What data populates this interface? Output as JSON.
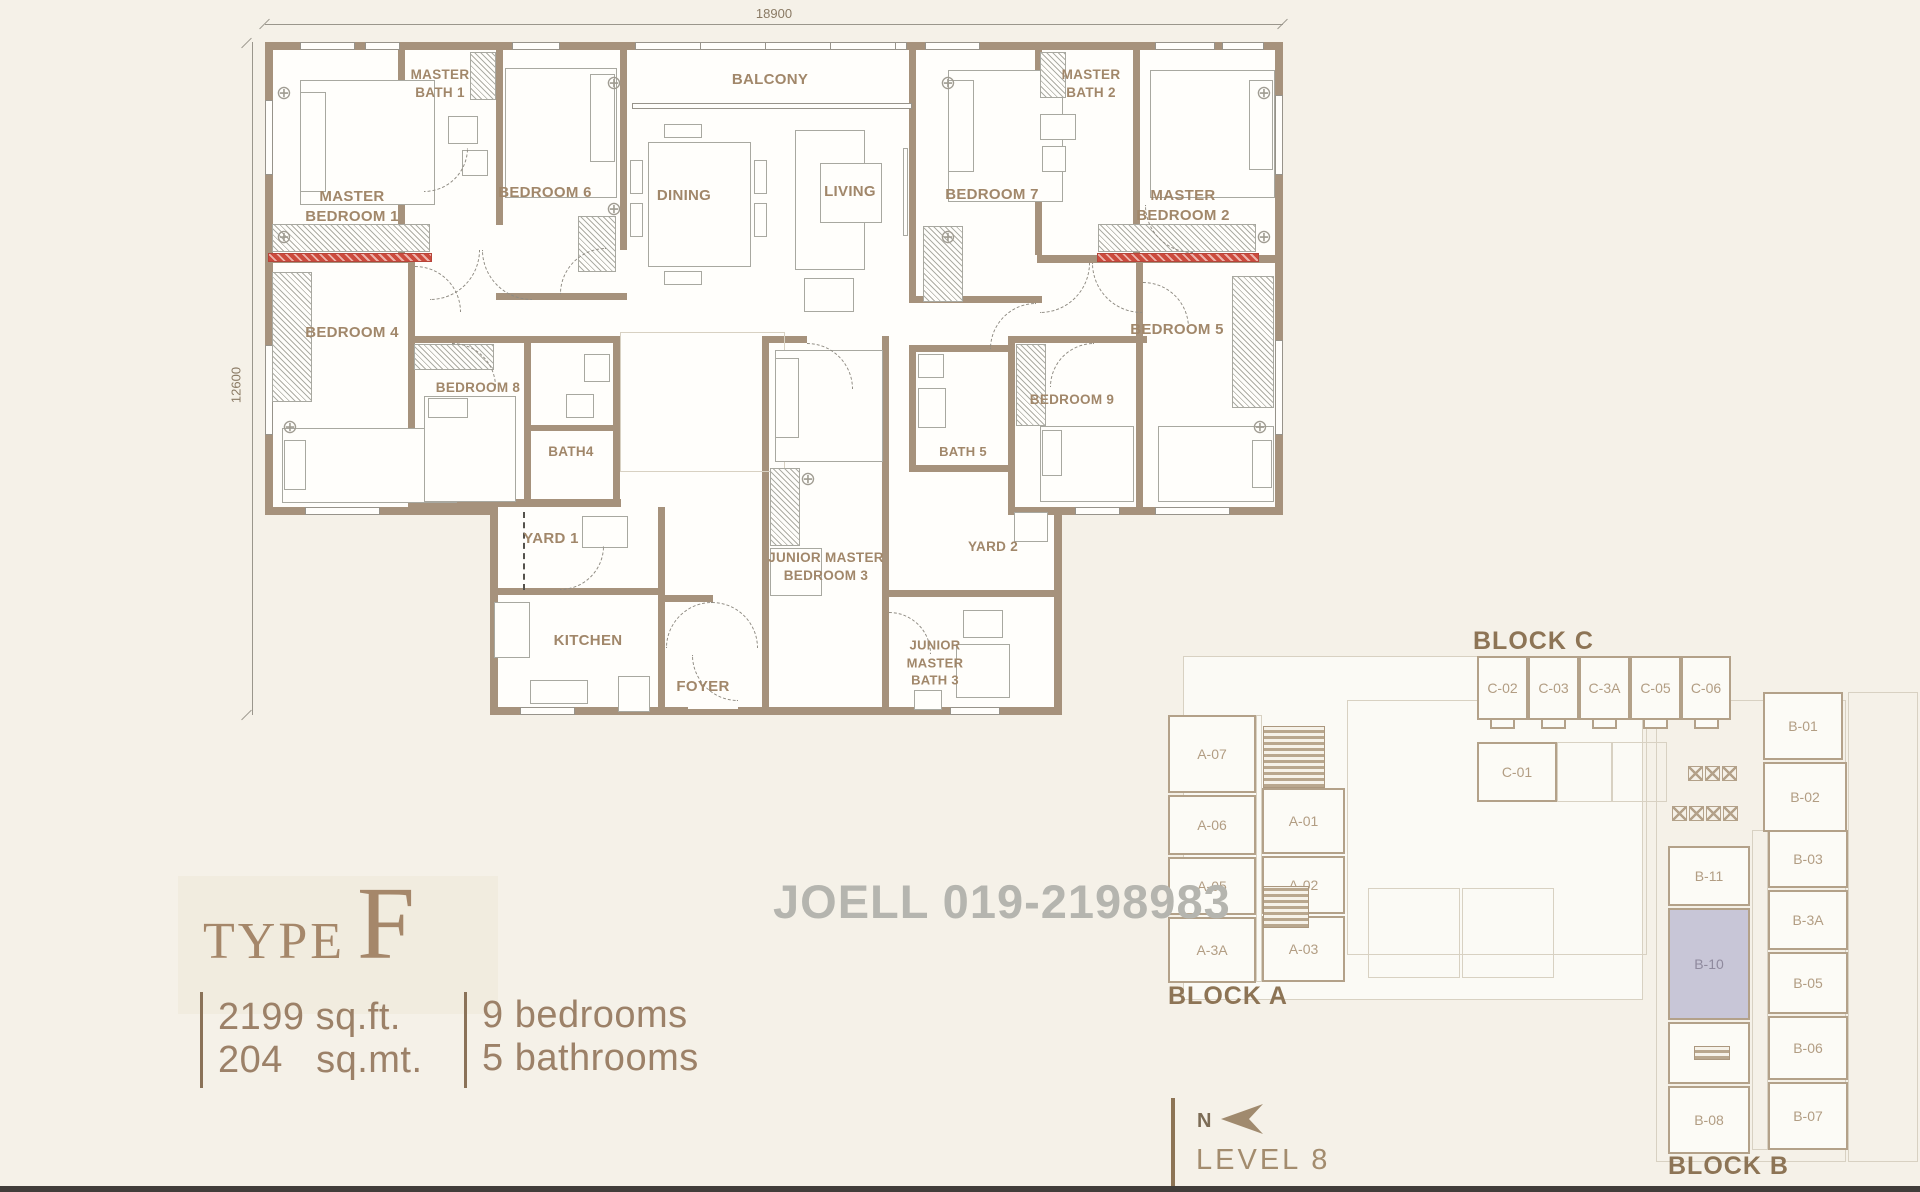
{
  "dimensions": {
    "top": "18900",
    "left": "12600"
  },
  "watermark": "JOELL 019-2198983",
  "title_block": {
    "type_word": "TYPE",
    "type_letter": "F",
    "area_imperial": "2199 sq.ft.",
    "area_metric": "204   sq.mt.",
    "bedrooms": "9 bedrooms",
    "bathrooms": "5 bathrooms"
  },
  "rooms": [
    {
      "id": "master-bedroom-1",
      "label": "MASTER\nBEDROOM 1"
    },
    {
      "id": "master-bath-1",
      "label": "MASTER\nBATH 1"
    },
    {
      "id": "bedroom-6",
      "label": "BEDROOM 6"
    },
    {
      "id": "balcony",
      "label": "BALCONY"
    },
    {
      "id": "dining",
      "label": "DINING"
    },
    {
      "id": "living",
      "label": "LIVING"
    },
    {
      "id": "bedroom-7",
      "label": "BEDROOM 7"
    },
    {
      "id": "master-bath-2",
      "label": "MASTER\nBATH 2"
    },
    {
      "id": "master-bedroom-2",
      "label": "MASTER\nBEDROOM 2"
    },
    {
      "id": "bedroom-4",
      "label": "BEDROOM 4"
    },
    {
      "id": "bedroom-8",
      "label": "BEDROOM 8"
    },
    {
      "id": "bath-4",
      "label": "BATH4"
    },
    {
      "id": "bedroom-9",
      "label": "BEDROOM 9"
    },
    {
      "id": "bath-5",
      "label": "BATH 5"
    },
    {
      "id": "bedroom-5",
      "label": "BEDROOM 5"
    },
    {
      "id": "yard-1",
      "label": "YARD 1"
    },
    {
      "id": "yard-2",
      "label": "YARD 2"
    },
    {
      "id": "junior-master-bedroom-3",
      "label": "JUNIOR MASTER\nBEDROOM 3"
    },
    {
      "id": "kitchen",
      "label": "KITCHEN"
    },
    {
      "id": "foyer",
      "label": "FOYER"
    },
    {
      "id": "junior-master-bath-3",
      "label": "JUNIOR\nMASTER\nBATH 3"
    }
  ],
  "keyplan": {
    "block_a_label": "BLOCK A",
    "block_b_label": "BLOCK B",
    "block_c_label": "BLOCK C",
    "north_label": "N",
    "level_label": "LEVEL 8",
    "highlighted_unit": "B-10",
    "units_c": [
      "C-02",
      "C-03",
      "C-3A",
      "C-05",
      "C-06",
      "C-01"
    ],
    "units_a": [
      "A-07",
      "A-06",
      "A-05",
      "A-3A",
      "A-01",
      "A-02",
      "A-03"
    ],
    "units_b": [
      "B-01",
      "B-02",
      "B-11",
      "B-10",
      "B-09",
      "B-08",
      "B-03",
      "B-3A",
      "B-05",
      "B-06",
      "B-07"
    ]
  },
  "colors": {
    "wall": "#a6927c",
    "room_label": "#a1876a",
    "red_strip": "#c0392b",
    "highlight_unit": "#c8c6d7",
    "keyplan_wall": "#b3a189",
    "watermark_gray": "#b5b5af"
  }
}
